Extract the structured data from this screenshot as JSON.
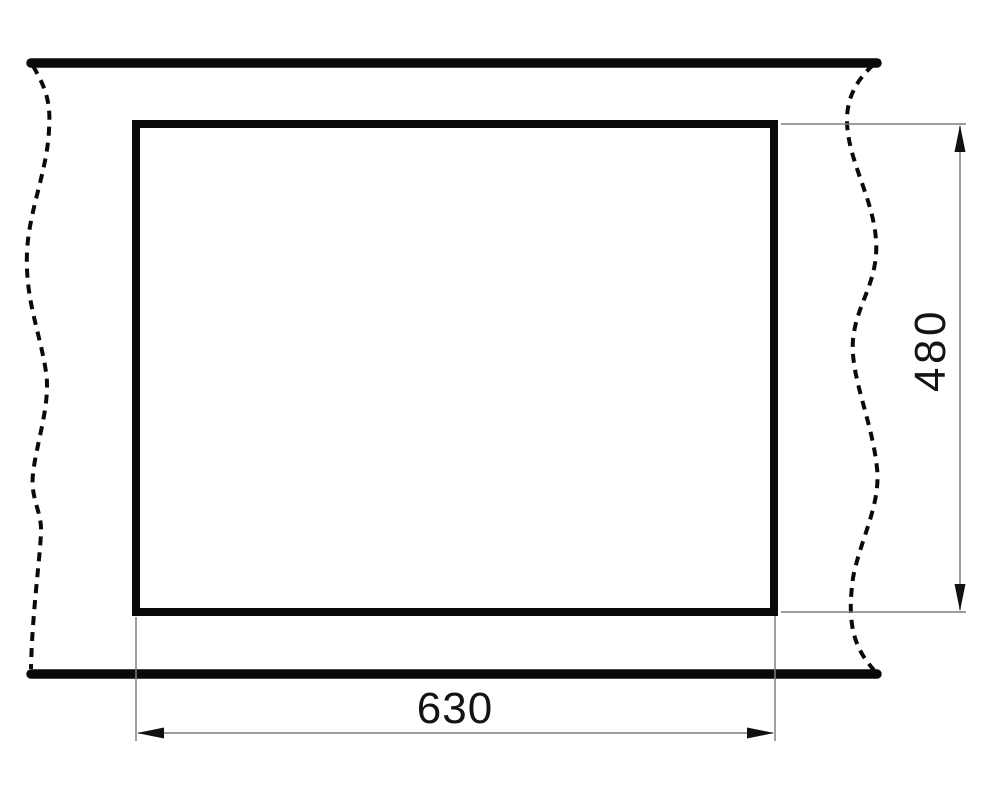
{
  "drawing": {
    "horizontal_dimension": {
      "label": "630"
    },
    "vertical_dimension": {
      "label": "480"
    },
    "colors": {
      "outline": "#0a0a0a",
      "thin_line": "#7f7f7f",
      "arrow": "#111111",
      "label_text": "#141414",
      "background": "#ffffff"
    }
  }
}
